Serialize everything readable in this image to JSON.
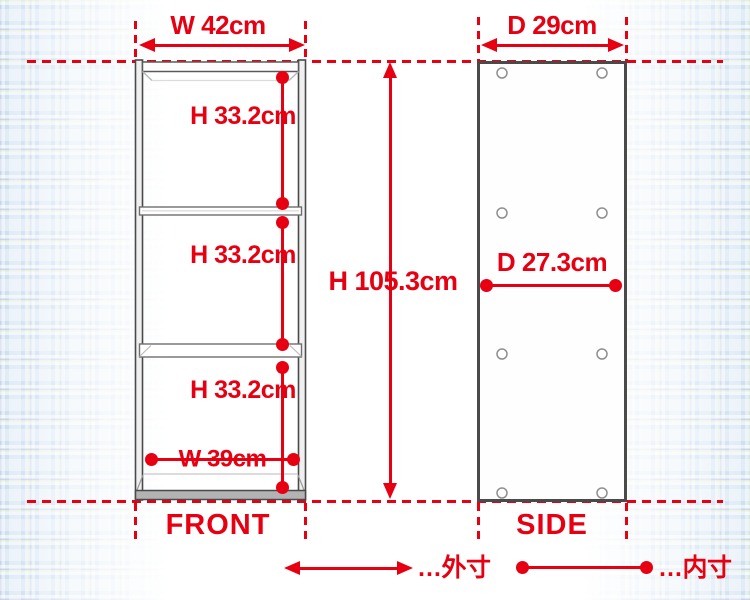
{
  "colors": {
    "dimension_red": "#e60012",
    "frame_dark": "#4a4a4a",
    "pattern_blue": "#ccdef0"
  },
  "front_view": {
    "label": "FRONT",
    "outer_width": "W 42cm",
    "overall_height": "H 105.3cm",
    "inner_width": "W 39cm",
    "sections": [
      {
        "height": "H 33.2cm"
      },
      {
        "height": "H 33.2cm"
      },
      {
        "height": "H 33.2cm"
      }
    ]
  },
  "side_view": {
    "label": "SIDE",
    "outer_depth": "D 29cm",
    "inner_depth": "D 27.3cm"
  },
  "legend": {
    "outer_dimension": "…外寸",
    "inner_dimension": "…内寸"
  }
}
